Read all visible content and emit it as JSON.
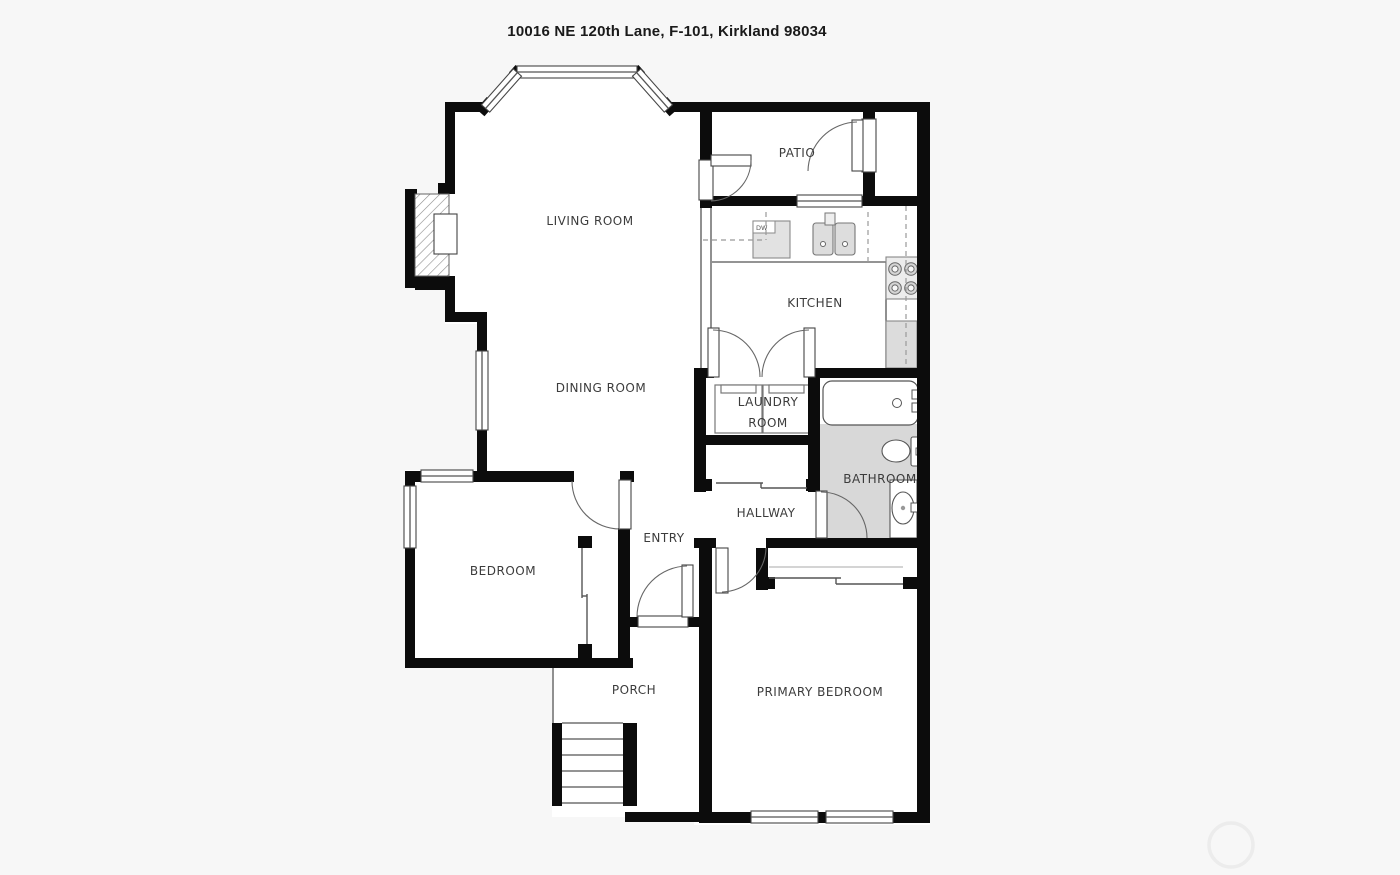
{
  "title": "10016 NE 120th Lane, F-101, Kirkland 98034",
  "floorplan": {
    "labels": {
      "living_room": "LIVING ROOM",
      "patio": "PATIO",
      "kitchen": "KITCHEN",
      "dining_room": "DINING ROOM",
      "laundry_room_line1": "LAUNDRY",
      "laundry_room_line2": "ROOM",
      "bathroom": "BATHROOM",
      "hallway": "HALLWAY",
      "entry": "ENTRY",
      "bedroom": "BEDROOM",
      "porch": "PORCH",
      "primary_bedroom": "PRIMARY BEDROOM",
      "dishwasher": "DW"
    },
    "features": [
      "bay-window",
      "fireplace",
      "patio-storage-closet",
      "kitchen-sink",
      "dishwasher",
      "stove-4-burner",
      "refrigerator",
      "french-doors",
      "washer",
      "dryer",
      "bathtub",
      "toilet",
      "vanity-sink",
      "hall-closet",
      "bedroom-closet",
      "primary-closet",
      "front-door",
      "porch-stairs",
      "watermark-circle"
    ],
    "colors": {
      "background": "#f7f7f7",
      "floor": "#ffffff",
      "wall": "#0c0c0c",
      "thin_line": "#555555",
      "tile_gray": "#d8d8d8",
      "fixture_gray": "#e2e2e2",
      "label_text": "#3c3c3c",
      "watermark": "#ececec"
    }
  }
}
